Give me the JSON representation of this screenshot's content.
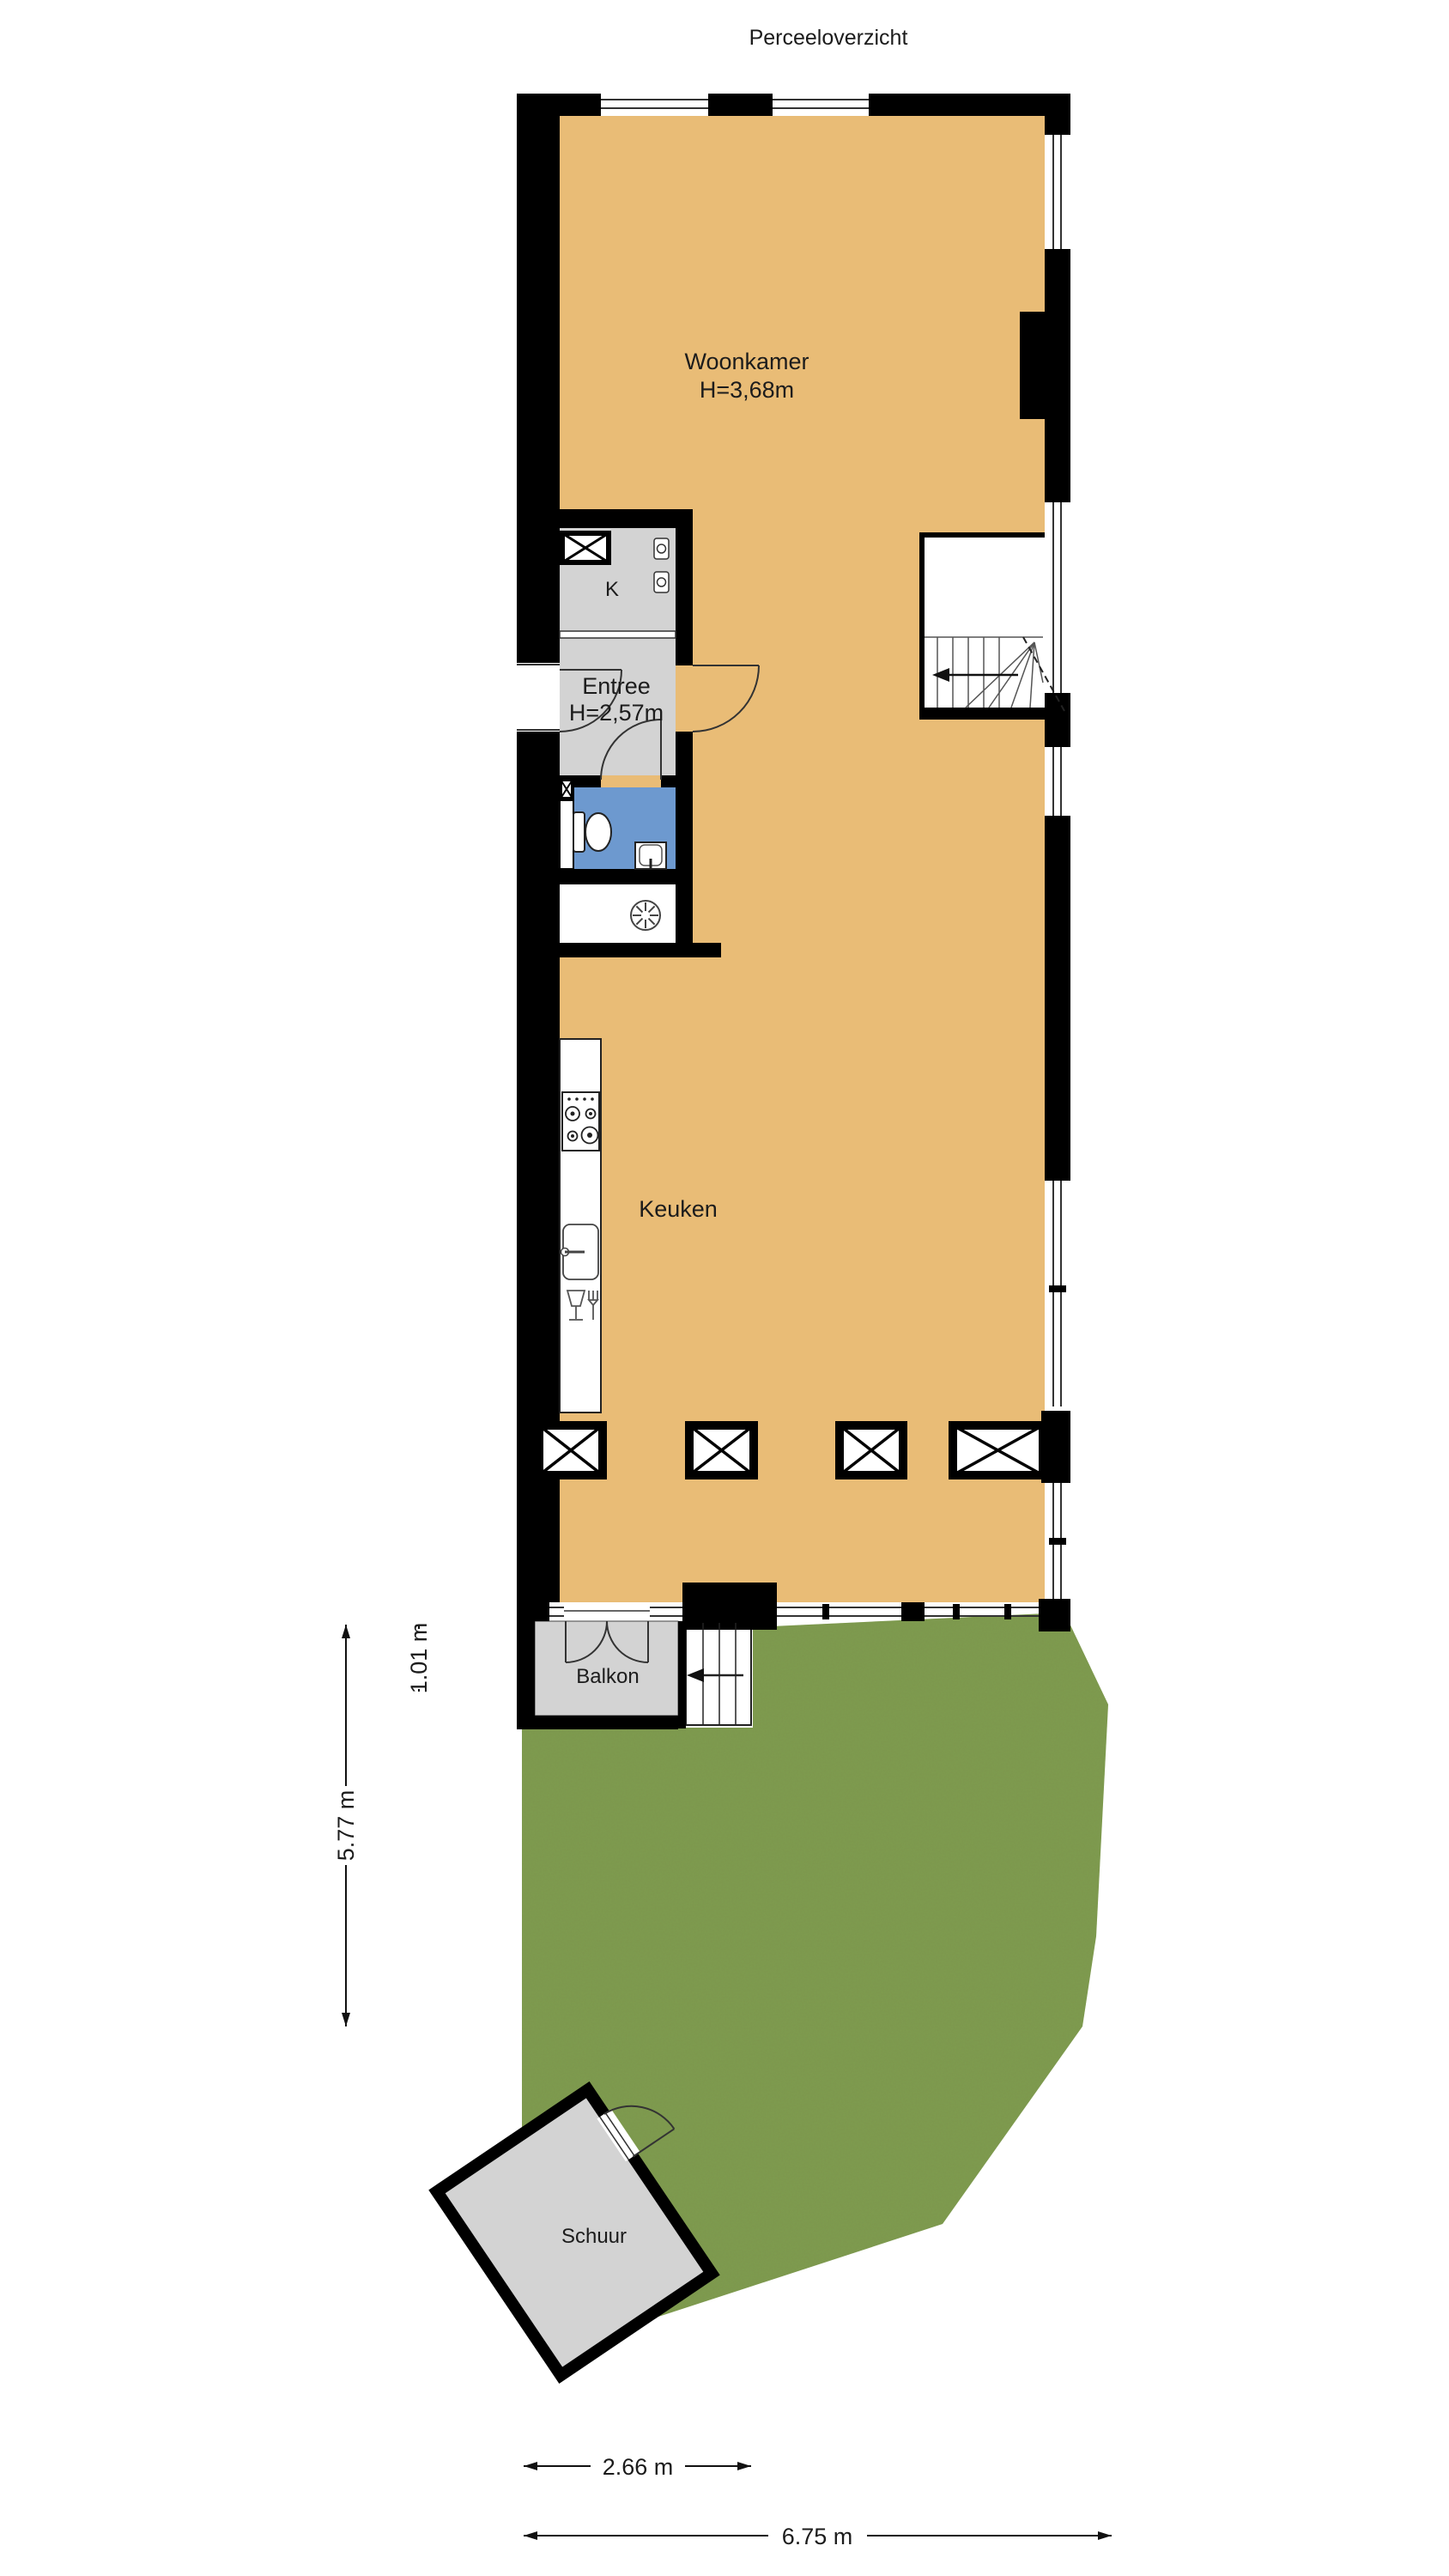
{
  "title": "Perceeloverzicht",
  "colors": {
    "floor_wood": "#e9bc76",
    "room_gray": "#d3d3d3",
    "bathroom_blue": "#6d99cf",
    "grass_green": "#7e9c4f",
    "wall_black": "#000000"
  },
  "rooms": {
    "woonkamer": {
      "label": "Woonkamer",
      "ceiling_height": "H=3,68m"
    },
    "entree": {
      "label": "Entree",
      "ceiling_height": "H=2,57m"
    },
    "closet": {
      "label": "K"
    },
    "keuken": {
      "label": "Keuken"
    },
    "balkon": {
      "label": "Balkon"
    },
    "schuur": {
      "label": "Schuur"
    }
  },
  "dimensions": {
    "balcony_depth": "1.01 m",
    "garden_depth": "5.77 m",
    "garden_width_partial": "2.66 m",
    "garden_width_total": "6.75 m"
  }
}
